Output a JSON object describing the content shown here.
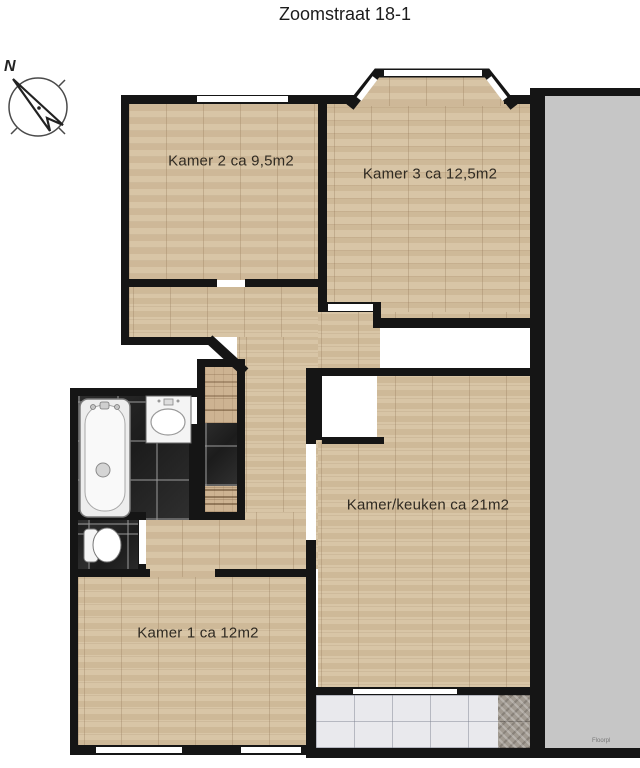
{
  "title": "Zoomstraat 18-1",
  "compass": {
    "label": "N"
  },
  "rooms": {
    "kamer2": {
      "label": "Kamer 2 ca 9,5m2"
    },
    "kamer3": {
      "label": "Kamer 3 ca 12,5m2"
    },
    "kamer_keuken": {
      "label": "Kamer/keuken ca 21m2"
    },
    "kamer1": {
      "label": "Kamer 1 ca 12m2"
    }
  },
  "icons": {
    "compass": "compass-north-icon",
    "bathtub": "bathtub-icon",
    "sink": "sink-icon",
    "toilet": "toilet-icon",
    "stairs": "staircase-icon",
    "closet": "closet-icon"
  },
  "colors": {
    "wall": "#151515",
    "wood_floor": "#d8c5a6",
    "wood_dark": "#cdb392",
    "dark_tile": "#242424",
    "white_tile": "#e9e9ed",
    "stone_tile": "#a19a91",
    "neighbor_gray": "#c6c6c6",
    "background": "#ffffff"
  },
  "watermark": "Floorpl"
}
